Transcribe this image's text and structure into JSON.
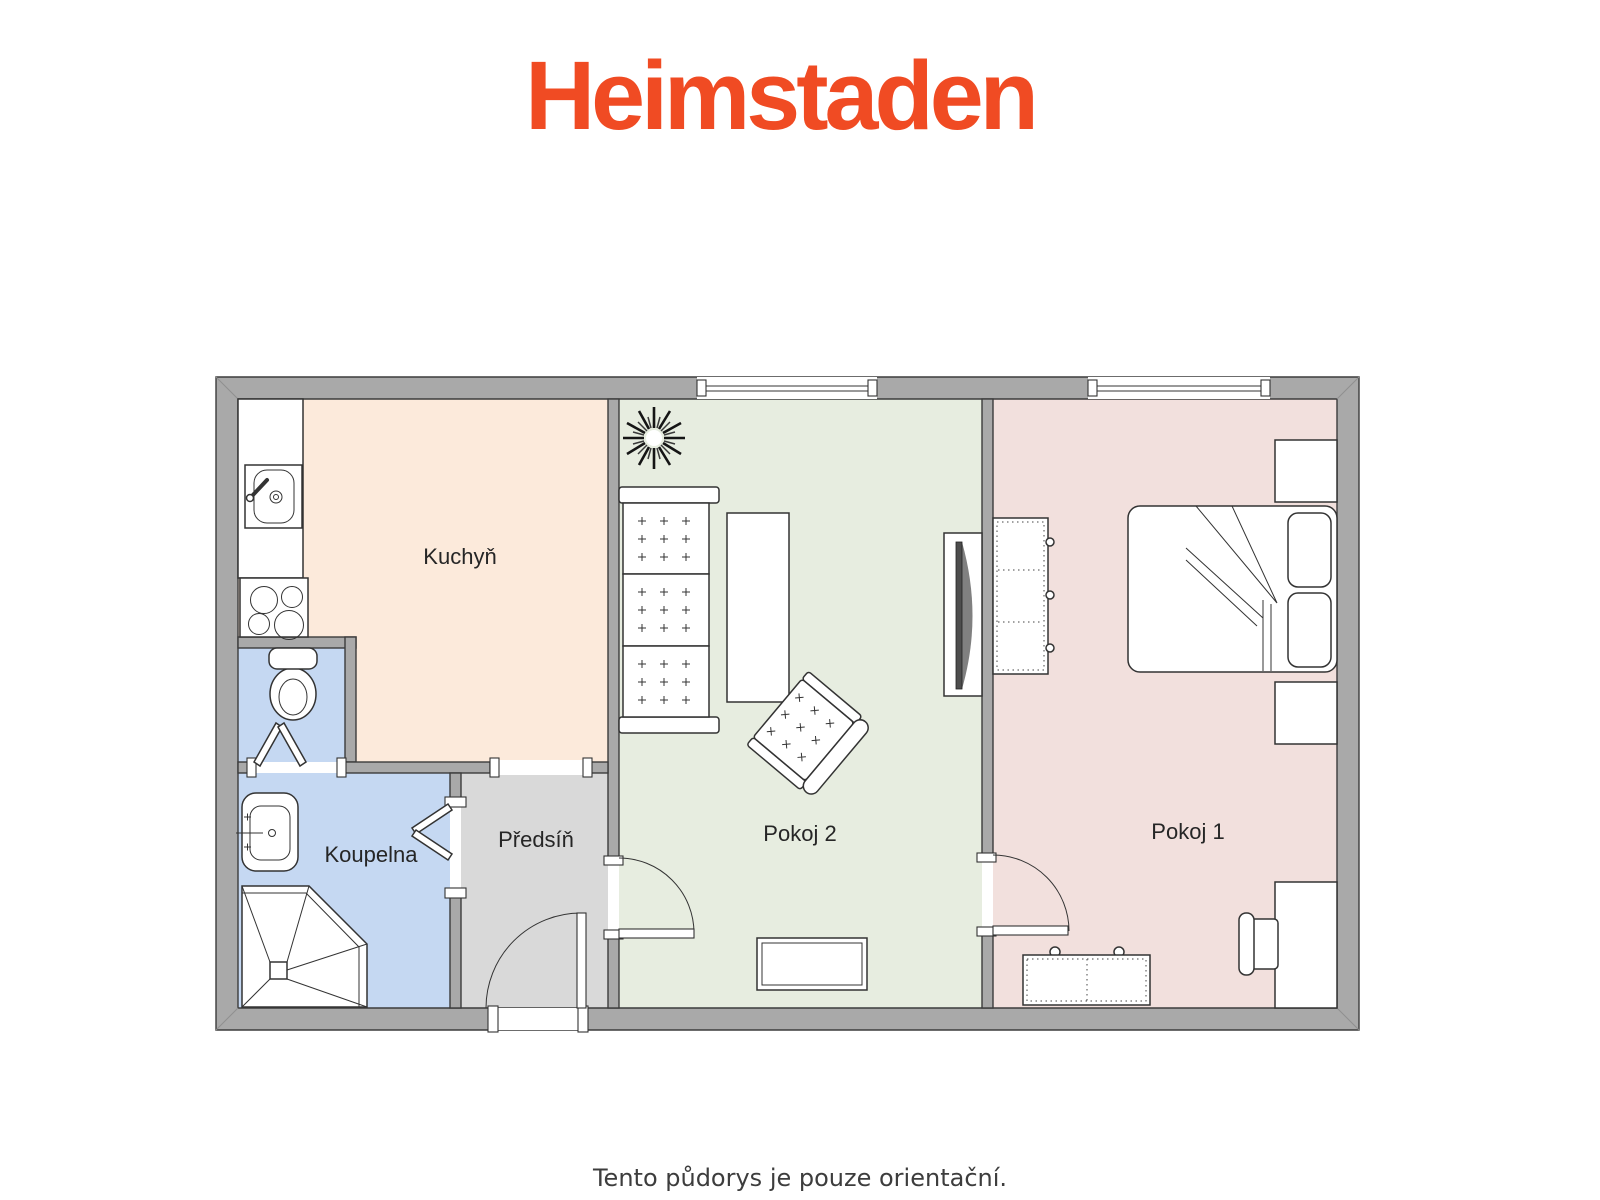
{
  "brand": {
    "logo_text": "Heimstaden",
    "brand_color": "#F04B23"
  },
  "floorplan": {
    "wall_color": "#A9A9A9",
    "outline_color": "#3C3C3C",
    "rooms": [
      {
        "id": "kuchyn",
        "label": "Kuchyň",
        "color": "#FCEADB",
        "fixtures": [
          "counter",
          "kitchen-sink-icon",
          "stove-icon"
        ]
      },
      {
        "id": "koupelna",
        "label": "Koupelna",
        "color": "#C5D8F2",
        "fixtures": [
          "washbasin-icon",
          "corner-shower-icon",
          "bifold-door-icon"
        ]
      },
      {
        "id": "predsin",
        "label": "Předsíň",
        "color": "#D9D9D9",
        "fixtures": [
          "entrance-door-icon"
        ]
      },
      {
        "id": "pokoj2",
        "label": "Pokoj 2",
        "color": "#E7EDE0",
        "fixtures": [
          "plant-icon",
          "sofa-icon",
          "coffee-table-icon",
          "tv-icon",
          "armchair-icon",
          "sideboard-icon",
          "window-icon"
        ]
      },
      {
        "id": "pokoj1",
        "label": "Pokoj 1",
        "color": "#F2E0DD",
        "fixtures": [
          "wardrobe-icon",
          "double-bed-icon",
          "nightstand-icon",
          "desk-icon",
          "chair-icon",
          "dresser-icon",
          "window-icon"
        ]
      },
      {
        "id": "wc",
        "label": "",
        "color": "#C5D8F2",
        "fixtures": [
          "toilet-icon",
          "bifold-door-icon"
        ]
      }
    ]
  },
  "footer": {
    "disclaimer": "Tento půdorys je pouze orientační."
  }
}
